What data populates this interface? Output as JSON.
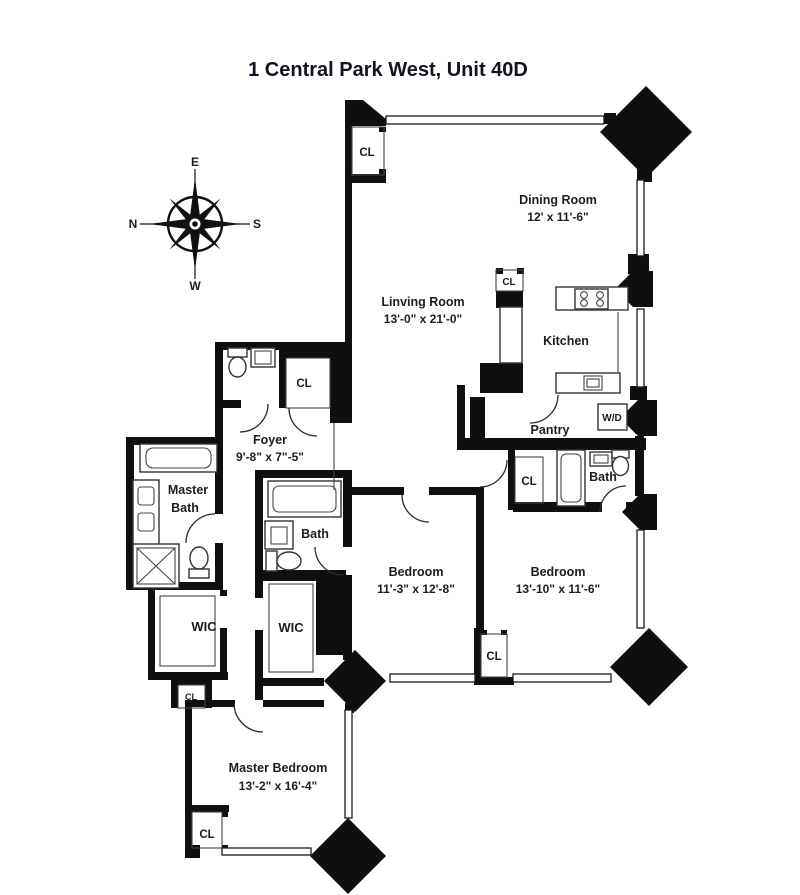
{
  "title": "1 Central Park West, Unit 40D",
  "compass": {
    "top": "E",
    "left": "N",
    "right": "S",
    "bottom": "W"
  },
  "labels": {
    "closet": "CL",
    "washer_dryer": "W/D"
  },
  "rooms": {
    "living": {
      "name": "Linving Room",
      "dims": "13'-0\" x 21'-0\""
    },
    "dining": {
      "name": "Dining Room",
      "dims": "12' x 11'-6\""
    },
    "kitchen": {
      "name": "Kitchen"
    },
    "pantry": {
      "name": "Pantry"
    },
    "foyer": {
      "name": "Foyer",
      "dims": "9'-8\" x 7\"-5\""
    },
    "master_bath": {
      "line1": "Master",
      "line2": "Bath"
    },
    "bath_middle": {
      "name": "Bath"
    },
    "bath_right": {
      "name": "Bath"
    },
    "wic_left": {
      "name": "WIC"
    },
    "wic_right": {
      "name": "WIC"
    },
    "bedroom_middle": {
      "name": "Bedroom",
      "dims": "11'-3\" x 12'-8\""
    },
    "bedroom_right": {
      "name": "Bedroom",
      "dims": "13'-10\" x 11'-6\""
    },
    "master_bedroom": {
      "name": "Master Bedroom",
      "dims": "13'-2\" x 16'-4\""
    }
  }
}
